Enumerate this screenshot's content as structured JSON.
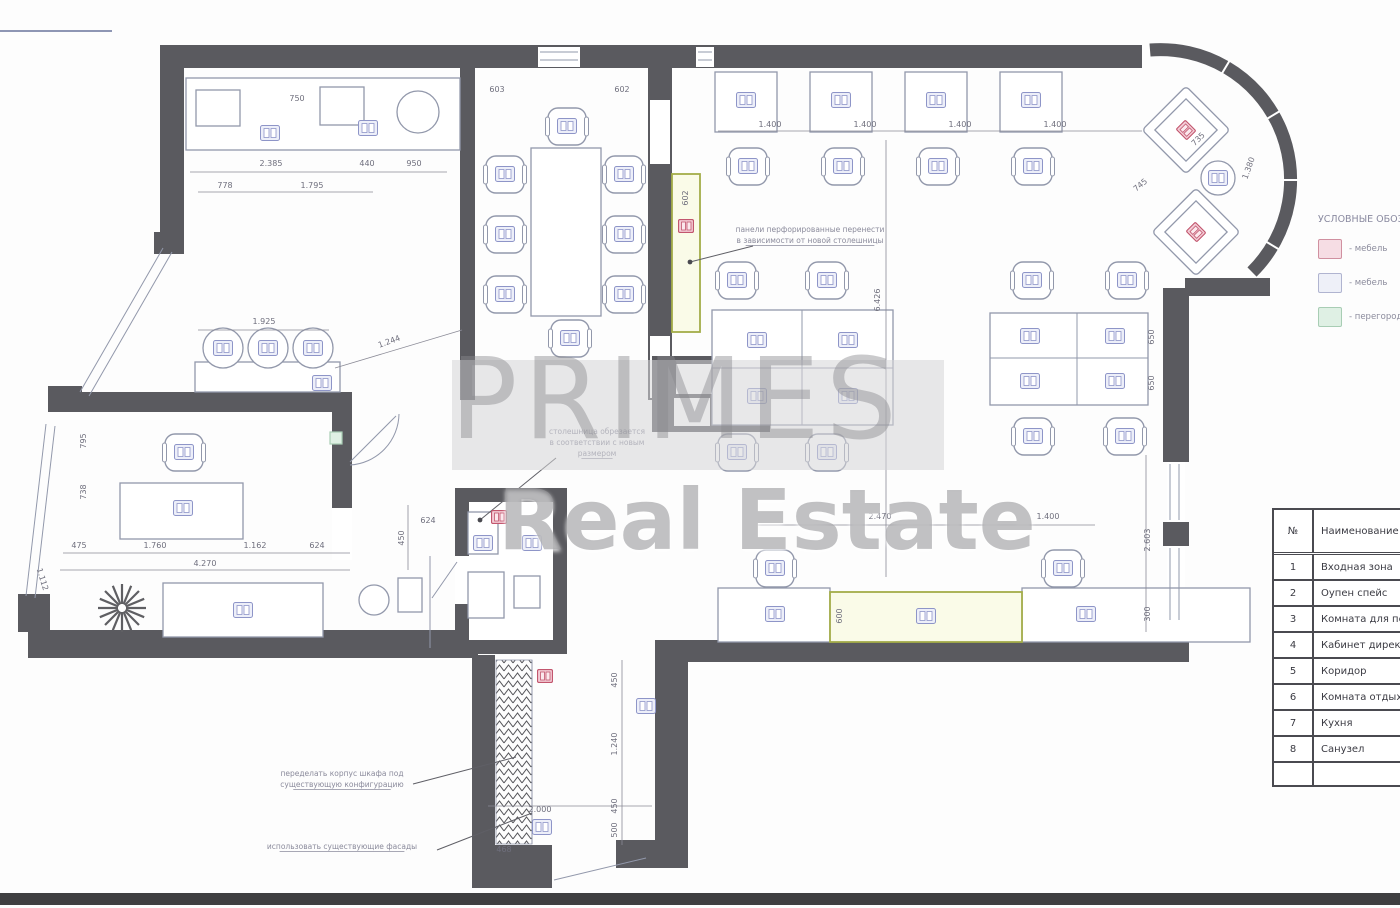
{
  "watermark": {
    "line1": "PRIMES",
    "line2": "Real Estate"
  },
  "legend": {
    "title": "УСЛОВНЫЕ ОБОЗНАЧЕНИЯ",
    "items": [
      {
        "type": "pink",
        "label": "- мебель"
      },
      {
        "type": "lavender",
        "label": "- мебель"
      },
      {
        "type": "green",
        "label": "- перегородки"
      }
    ]
  },
  "rooms_table": {
    "col1": "№",
    "col2": "Наименование",
    "rows": [
      [
        "1",
        "Входная зона"
      ],
      [
        "2",
        "Оупен спейс"
      ],
      [
        "3",
        "Комната для переговоров"
      ],
      [
        "4",
        "Кабинет директора"
      ],
      [
        "5",
        "Коридор"
      ],
      [
        "6",
        "Комната отдыха"
      ],
      [
        "7",
        "Кухня"
      ],
      [
        "8",
        "Санузел"
      ]
    ]
  },
  "colors": {
    "wall": "#5a5a5f",
    "furniture": "#9298ab",
    "icon_stroke": "#8e95c8",
    "icon_fill": "#edeff9",
    "pink_stroke": "#c2566e",
    "pink_fill": "#f3ccd6",
    "green_stroke": "#a3ad49",
    "green_fill": "#fafbe8",
    "dim_text": "#6f6f7d",
    "note_text": "#8b8b9c"
  },
  "plan": {
    "dimensions": [
      [
        "2.385",
        271,
        166,
        0
      ],
      [
        "440",
        367,
        166,
        0
      ],
      [
        "950",
        414,
        166,
        0
      ],
      [
        "750",
        297,
        101,
        0
      ],
      [
        "778",
        225,
        188,
        0
      ],
      [
        "1.795",
        312,
        188,
        0
      ],
      [
        "1.925",
        264,
        324,
        0
      ],
      [
        "1.244",
        390,
        344,
        -20
      ],
      [
        "603",
        497,
        92,
        0
      ],
      [
        "602",
        622,
        92,
        0
      ],
      [
        "602",
        688,
        198,
        -90
      ],
      [
        "1.400",
        770,
        127,
        0
      ],
      [
        "1.400",
        865,
        127,
        0
      ],
      [
        "1.400",
        960,
        127,
        0
      ],
      [
        "1.400",
        1055,
        127,
        0
      ],
      [
        "6.426",
        880,
        300,
        -90
      ],
      [
        "650",
        1154,
        337,
        -90
      ],
      [
        "650",
        1154,
        383,
        -90
      ],
      [
        "2.603",
        1150,
        540,
        -90
      ],
      [
        "300",
        1150,
        614,
        -90
      ],
      [
        "2.470",
        880,
        519,
        0
      ],
      [
        "1.400",
        1048,
        519,
        0
      ],
      [
        "600",
        842,
        616,
        -90
      ],
      [
        "735",
        1200,
        141,
        -45
      ],
      [
        "1.380",
        1251,
        169,
        -70
      ],
      [
        "745",
        1142,
        187,
        -40
      ],
      [
        "475",
        79,
        548,
        0
      ],
      [
        "1.760",
        155,
        548,
        0
      ],
      [
        "1.162",
        255,
        548,
        0
      ],
      [
        "624",
        317,
        548,
        0
      ],
      [
        "4.270",
        205,
        566,
        0
      ],
      [
        "795",
        86,
        441,
        -90
      ],
      [
        "738",
        86,
        492,
        -90
      ],
      [
        "1.112",
        40,
        580,
        73
      ],
      [
        "450",
        404,
        538,
        -90
      ],
      [
        "624",
        428,
        523,
        0
      ],
      [
        "450",
        617,
        680,
        -90
      ],
      [
        "1.240",
        617,
        744,
        -90
      ],
      [
        "450",
        617,
        806,
        -90
      ],
      [
        "500",
        617,
        830,
        -90
      ],
      [
        "468",
        504,
        852,
        0
      ],
      [
        "2.000",
        540,
        812,
        0
      ]
    ],
    "dim_lines": [
      [
        190,
        172,
        447,
        172
      ],
      [
        198,
        192,
        373,
        192
      ],
      [
        198,
        330,
        329,
        330
      ],
      [
        718,
        131,
        1142,
        131
      ],
      [
        886,
        140,
        886,
        577
      ],
      [
        758,
        525,
        1095,
        525
      ],
      [
        63,
        553,
        350,
        553
      ],
      [
        60,
        570,
        350,
        570
      ],
      [
        622,
        660,
        622,
        845
      ],
      [
        1146,
        455,
        1146,
        632
      ],
      [
        335,
        368,
        462,
        330
      ],
      [
        408,
        505,
        408,
        570
      ],
      [
        488,
        806,
        652,
        806
      ]
    ],
    "notes": [
      {
        "lines": [
          "панели перфорированные перенести",
          "в зависимости от новой столешницы"
        ],
        "x": 810,
        "y": 232,
        "u": [
          1
        ]
      },
      {
        "lines": [
          "столешница обрезается",
          "в соответствии с новым",
          "размером"
        ],
        "x": 597,
        "y": 434,
        "u": [
          2
        ]
      },
      {
        "lines": [
          "переделать корпус шкафа под",
          "существующую конфигурацию"
        ],
        "x": 342,
        "y": 776,
        "u": [
          1
        ]
      },
      {
        "lines": [
          "использовать существующие фасады"
        ],
        "x": 342,
        "y": 849,
        "u": [
          0
        ]
      }
    ],
    "leaders": [
      {
        "pts": [
          [
            753,
            246
          ],
          [
            690,
            262
          ]
        ],
        "dot": true
      },
      {
        "pts": [
          [
            556,
            458
          ],
          [
            480,
            520
          ]
        ],
        "dot": true
      },
      {
        "pts": [
          [
            413,
            784
          ],
          [
            516,
            757
          ]
        ],
        "dot": false
      },
      {
        "pts": [
          [
            437,
            850
          ],
          [
            532,
            813
          ]
        ],
        "dot": false
      }
    ],
    "desks": [
      [
        715,
        72,
        62,
        60
      ],
      [
        810,
        72,
        62,
        60
      ],
      [
        905,
        72,
        62,
        60
      ],
      [
        1000,
        72,
        62,
        60
      ],
      [
        712,
        310,
        181,
        115
      ],
      [
        990,
        313,
        158,
        92
      ],
      [
        718,
        588,
        112,
        54
      ],
      [
        1022,
        588,
        228,
        54
      ],
      [
        120,
        483,
        123,
        56
      ],
      [
        163,
        583,
        160,
        54
      ],
      [
        186,
        78,
        274,
        72
      ],
      [
        196,
        90,
        44,
        36
      ],
      [
        320,
        87,
        44,
        38
      ],
      [
        195,
        362,
        145,
        30
      ],
      [
        531,
        148,
        70,
        168
      ],
      [
        468,
        512,
        30,
        42
      ],
      [
        468,
        572,
        36,
        46
      ],
      [
        514,
        576,
        26,
        32
      ],
      [
        398,
        578,
        24,
        34
      ]
    ],
    "green_boxes": [
      [
        672,
        174,
        28,
        158
      ],
      [
        830,
        592,
        192,
        50
      ]
    ],
    "chairs": [
      [
        545,
        104
      ],
      [
        548,
        316
      ],
      [
        483,
        152
      ],
      [
        483,
        212
      ],
      [
        483,
        272
      ],
      [
        602,
        152
      ],
      [
        602,
        212
      ],
      [
        602,
        272
      ],
      [
        726,
        144
      ],
      [
        821,
        144
      ],
      [
        916,
        144
      ],
      [
        1011,
        144
      ],
      [
        715,
        258
      ],
      [
        805,
        258
      ],
      [
        715,
        430
      ],
      [
        805,
        430
      ],
      [
        1010,
        258
      ],
      [
        1105,
        258
      ],
      [
        1011,
        414
      ],
      [
        1103,
        414
      ],
      [
        753,
        546
      ],
      [
        1041,
        546
      ],
      [
        162,
        430
      ]
    ],
    "armchairs": [
      [
        1186,
        130,
        45
      ],
      [
        1196,
        232,
        45
      ]
    ],
    "circles": [
      [
        418,
        112,
        21
      ],
      [
        223,
        348,
        20
      ],
      [
        268,
        348,
        20
      ],
      [
        313,
        348,
        20
      ],
      [
        1218,
        178,
        17
      ],
      [
        374,
        600,
        15
      ]
    ],
    "furn_icons": [
      [
        270,
        133
      ],
      [
        368,
        128
      ],
      [
        223,
        348
      ],
      [
        268,
        348
      ],
      [
        313,
        348
      ],
      [
        322,
        383
      ],
      [
        567,
        126
      ],
      [
        570,
        338
      ],
      [
        505,
        174
      ],
      [
        505,
        234
      ],
      [
        505,
        294
      ],
      [
        624,
        174
      ],
      [
        624,
        234
      ],
      [
        624,
        294
      ],
      [
        746,
        100
      ],
      [
        841,
        100
      ],
      [
        936,
        100
      ],
      [
        1031,
        100
      ],
      [
        748,
        166
      ],
      [
        843,
        166
      ],
      [
        938,
        166
      ],
      [
        1033,
        166
      ],
      [
        757,
        340
      ],
      [
        848,
        340
      ],
      [
        757,
        396
      ],
      [
        848,
        396
      ],
      [
        737,
        280
      ],
      [
        827,
        280
      ],
      [
        737,
        452
      ],
      [
        827,
        452
      ],
      [
        1030,
        336
      ],
      [
        1115,
        336
      ],
      [
        1030,
        381
      ],
      [
        1115,
        381
      ],
      [
        1032,
        280
      ],
      [
        1127,
        280
      ],
      [
        1033,
        436
      ],
      [
        1125,
        436
      ],
      [
        775,
        614
      ],
      [
        926,
        616
      ],
      [
        1086,
        614
      ],
      [
        775,
        568
      ],
      [
        1063,
        568
      ],
      [
        183,
        508
      ],
      [
        184,
        452
      ],
      [
        243,
        610
      ],
      [
        646,
        706
      ],
      [
        542,
        827
      ],
      [
        483,
        543
      ],
      [
        532,
        543
      ],
      [
        1218,
        178
      ]
    ],
    "pink_markers": [
      [
        686,
        226
      ],
      [
        499,
        517
      ],
      [
        545,
        676
      ]
    ],
    "green_markers": [
      [
        336,
        438
      ]
    ],
    "divider_lines": [
      [
        802,
        310,
        802,
        425
      ],
      [
        712,
        368,
        893,
        368
      ],
      [
        1077,
        313,
        1077,
        405
      ],
      [
        990,
        358,
        1148,
        358
      ],
      [
        540,
        52,
        578,
        52
      ],
      [
        540,
        60,
        578,
        60
      ],
      [
        698,
        52,
        712,
        52
      ],
      [
        698,
        60,
        712,
        60
      ],
      [
        1170,
        464,
        1170,
        520
      ],
      [
        1179,
        464,
        1179,
        520
      ],
      [
        1170,
        548,
        1170,
        620
      ],
      [
        1179,
        548,
        1179,
        620
      ],
      [
        163,
        248,
        80,
        392
      ],
      [
        172,
        252,
        89,
        396
      ],
      [
        46,
        424,
        26,
        596
      ],
      [
        55,
        426,
        35,
        598
      ],
      [
        554,
        880,
        646,
        858
      ],
      [
        350,
        462,
        396,
        416
      ],
      [
        457,
        562,
        432,
        598
      ],
      [
        400,
        112,
        436,
        112
      ],
      [
        418,
        94,
        418,
        130
      ],
      [
        430,
        556,
        430,
        648
      ]
    ],
    "plant": {
      "x": 122,
      "y": 608,
      "r": 24
    }
  }
}
